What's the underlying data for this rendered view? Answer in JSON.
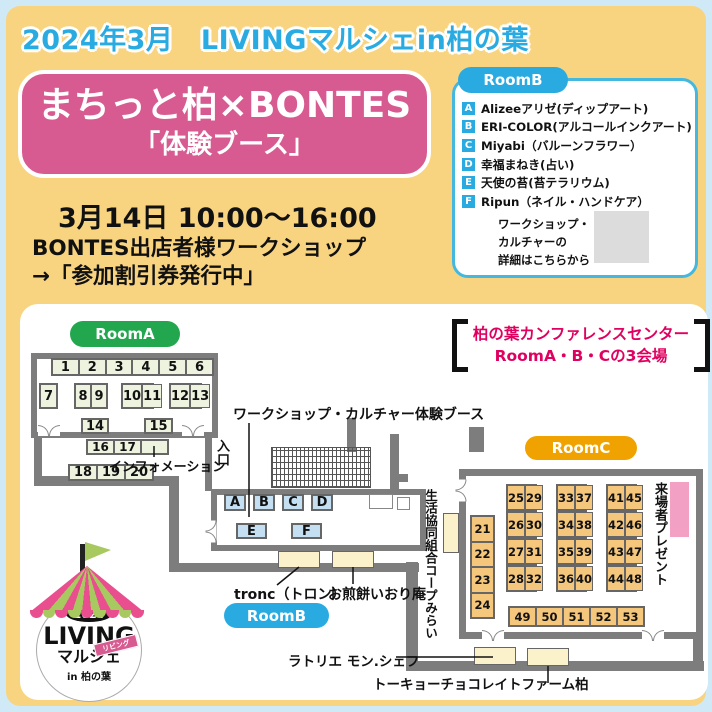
{
  "colors": {
    "page_bg": "#f8d480",
    "frame": "#cfeaf6",
    "cyan": "#29abe2",
    "green": "#22a74e",
    "orange": "#f0a300",
    "pink": "#d75b90",
    "red": "#e0005f",
    "wall": "#7d7d7d",
    "booth_green": "#edf3df",
    "booth_blue": "#c4dff2",
    "booth_tan": "#f4c77d",
    "cream": "#fbf2cc",
    "lightpink": "#f2a0c4"
  },
  "header": {
    "banner": "2024年3月　LIVINGマルシェin柏の葉",
    "title": "まちっと柏×BONTES",
    "subtitle": "「体験ブース」",
    "date": "3月14日 10:00～16:00",
    "workshop_note1": "BONTES出店者様ワークショップ",
    "workshop_note2": "→「参加割引券発行中」"
  },
  "room_b_panel": {
    "label": "RoomB",
    "exhibitors": [
      {
        "badge": "A",
        "text": "Alizeeアリゼ(ディップアート)"
      },
      {
        "badge": "B",
        "text": "ERI-COLOR(アルコールインクアート)"
      },
      {
        "badge": "C",
        "text": "Miyabi（バルーンフラワー）"
      },
      {
        "badge": "D",
        "text": "幸福まねき(占い)"
      },
      {
        "badge": "E",
        "text": "天使の苔(苔テラリウム)"
      },
      {
        "badge": "F",
        "text": "Ripun（ネイル・ハンドケア）"
      }
    ],
    "qr_note_lines": [
      "ワークショップ・",
      "カルチャーの",
      "詳細はこちらから"
    ]
  },
  "venue": {
    "line1": "柏の葉カンファレンスセンター",
    "line2": "RoomA・B・Cの3会場"
  },
  "map": {
    "room_a": {
      "label": "RoomA",
      "top_strip": [
        "1",
        "2",
        "3",
        "4",
        "5",
        "6"
      ],
      "pair_row": [
        [
          "7"
        ],
        [
          "8",
          "9"
        ],
        [
          "10",
          "11"
        ],
        [
          "12",
          "13"
        ]
      ],
      "mid_row": [
        "14",
        "15"
      ],
      "info_strip": [
        "16",
        "17",
        ""
      ],
      "lower_strip": [
        "18",
        "19",
        "20"
      ],
      "info_label": "インフォメーション"
    },
    "room_b": {
      "label": "RoomB",
      "booths_top": [
        "A",
        "B",
        "C",
        "D"
      ],
      "booths_bottom": [
        "E",
        "F"
      ],
      "entrance_label": "入口",
      "workshop_label": "ワークショップ・カルチャー体験ブース",
      "outside_booth_labels": [
        "tronc（トロン）",
        "お煎餅いおり庵"
      ]
    },
    "room_c": {
      "label": "RoomC",
      "left_column": [
        "21",
        "22",
        "23",
        "24"
      ],
      "blocks": [
        [
          [
            "25",
            "29"
          ],
          [
            "26",
            "30"
          ],
          [
            "27",
            "31"
          ],
          [
            "28",
            "32"
          ]
        ],
        [
          [
            "33",
            "37"
          ],
          [
            "34",
            "38"
          ],
          [
            "35",
            "39"
          ],
          [
            "36",
            "40"
          ]
        ],
        [
          [
            "41",
            "45"
          ],
          [
            "42",
            "46"
          ],
          [
            "43",
            "47"
          ],
          [
            "44",
            "48"
          ]
        ]
      ],
      "bottom_row": [
        "49",
        "50",
        "51",
        "52",
        "53"
      ],
      "present_label": "来場者プレゼント"
    },
    "corridor": {
      "coop_label": "生活協同組合コープみらい",
      "latelier_label": "ラトリエ モン.シェフ",
      "chocolate_label": "トーキョーチョコレイトファーム柏"
    }
  },
  "logo": {
    "year": "2024",
    "name": "LIVING",
    "name2": "マルシェ",
    "ribbon": "リビング",
    "location": "in 柏の葉"
  }
}
